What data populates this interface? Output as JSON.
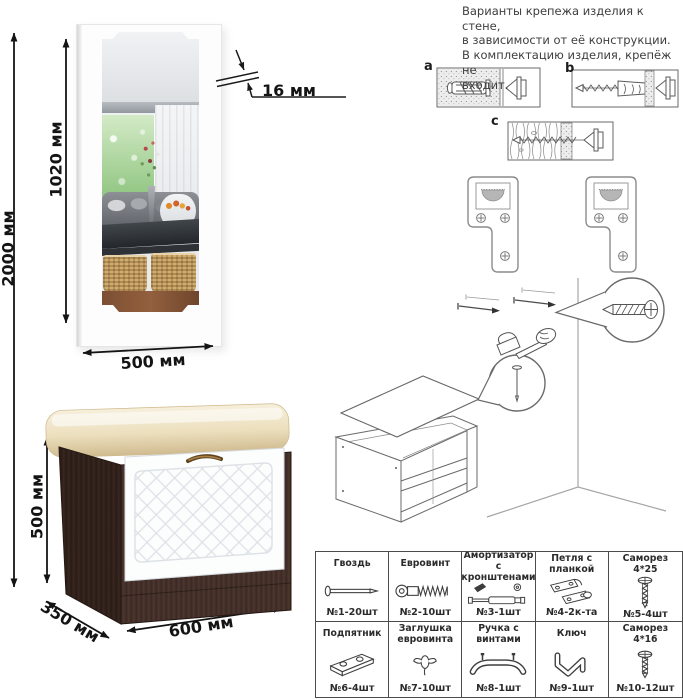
{
  "header_note": "Варианты крепежа изделия к стене,\nв зависимости от её конструкции.\nВ комплектацию изделия, крепёж не\nвходит.",
  "wall_mount_options": {
    "a": "a",
    "b": "b",
    "c": "c"
  },
  "dimensions": {
    "total_height": "2000 мм",
    "mirror_height": "1020 мм",
    "mirror_width": "500 мм",
    "panel_thickness": "16 мм",
    "bench_height": "500 мм",
    "bench_depth": "350 мм",
    "bench_width": "600 мм"
  },
  "parts_table": {
    "items": [
      {
        "name": "Гвоздь",
        "qty": "№1-20шт",
        "icon": "nail-icon"
      },
      {
        "name": "Евровинт",
        "qty": "№2-10шт",
        "icon": "euro-screw-icon"
      },
      {
        "name": "Амортизатор с кронштенами",
        "qty": "№3-1шт",
        "icon": "gas-lift-icon"
      },
      {
        "name": "Петля с планкой",
        "qty": "№4-2к-та",
        "icon": "hinge-icon"
      },
      {
        "name": "Саморез 4*25",
        "qty": "№5-4шт",
        "icon": "screw-long-icon"
      },
      {
        "name": "Подпятник",
        "qty": "№6-4шт",
        "icon": "glide-icon"
      },
      {
        "name": "Заглушка евровинта",
        "qty": "№7-10шт",
        "icon": "cap-icon"
      },
      {
        "name": "Ручка с винтами",
        "qty": "№8-1шт",
        "icon": "handle-icon"
      },
      {
        "name": "Ключ",
        "qty": "№9-1шт",
        "icon": "hex-key-icon"
      },
      {
        "name": "Саморез 4*16",
        "qty": "№10-12шт",
        "icon": "screw-short-icon"
      }
    ]
  },
  "colors": {
    "bench_body": "#35241e",
    "bench_front": "#44302a",
    "cushion": "#efe3c2",
    "door": "#fcfdfd",
    "dimension_text": "#141414"
  }
}
